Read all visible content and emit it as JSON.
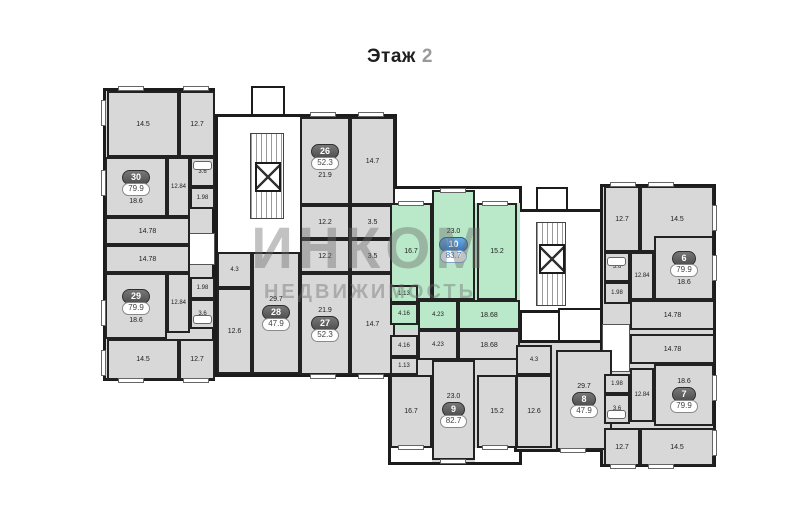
{
  "title": {
    "label": "Этаж",
    "number": "2"
  },
  "watermark": {
    "line1": "ИНКОМ",
    "line2": "НЕДВИЖИМОСТЬ"
  },
  "colors": {
    "room_gray": "#d8d8d8",
    "wall": "#1c1c1c",
    "highlight_green": "#b9e9c9",
    "badge_gray": "#5f5f5f",
    "badge_blue": "#3577bd"
  },
  "apartments": [
    {
      "number": "30",
      "area": "79.9",
      "rooms": [
        "14.5",
        "12.7",
        "18.6",
        "12.84",
        "3.6",
        "1.98",
        "14.78"
      ]
    },
    {
      "number": "29",
      "area": "79.9",
      "rooms": [
        "14.78",
        "1.98",
        "12.84",
        "3.6",
        "18.6",
        "14.5",
        "12.7"
      ]
    },
    {
      "number": "26",
      "area": "52.3",
      "rooms": [
        "21.9",
        "14.7",
        "12.2",
        "3.5"
      ]
    },
    {
      "number": "27",
      "area": "52.3",
      "rooms": [
        "12.2",
        "3.5",
        "21.9",
        "14.7"
      ]
    },
    {
      "number": "28",
      "area": "47.9",
      "rooms": [
        "4.3",
        "12.6",
        "29.7"
      ]
    },
    {
      "number": "10",
      "area": "83.7",
      "rooms": [
        "16.7",
        "23.0",
        "15.2",
        "1.13",
        "4.16",
        "4.23",
        "18.68"
      ]
    },
    {
      "number": "9",
      "area": "82.7",
      "rooms": [
        "4.23",
        "4.16",
        "18.68",
        "1.13",
        "16.7",
        "23.0",
        "15.2"
      ]
    },
    {
      "number": "8",
      "area": "47.9",
      "rooms": [
        "4.3",
        "12.6",
        "29.7"
      ]
    },
    {
      "number": "6",
      "area": "79.9",
      "rooms": [
        "12.7",
        "14.5",
        "3.6",
        "1.98",
        "12.84",
        "18.6",
        "14.78"
      ]
    },
    {
      "number": "7",
      "area": "79.9",
      "rooms": [
        "14.78",
        "1.98",
        "3.6",
        "12.84",
        "18.6",
        "12.7",
        "14.5"
      ]
    }
  ]
}
